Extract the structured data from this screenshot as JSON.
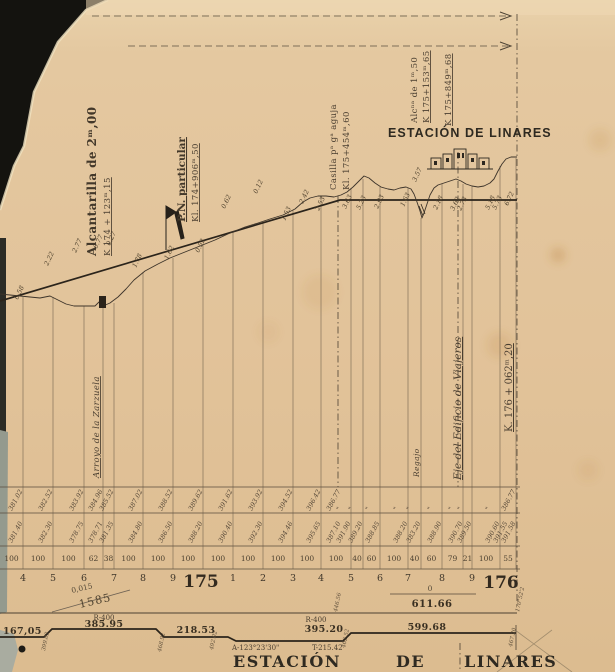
{
  "labels": {
    "alc2": {
      "l1": "Alcantarilla de 2ᵐ,00",
      "l2": "K 174 + 123ᵐ,15"
    },
    "pn": {
      "l1": "P.N. particular",
      "l2": "Kl. 174+906ᵐ,50"
    },
    "casilla": {
      "l1": "Casilla pᵃ gᵃ aguja",
      "l2": "Kl. 175+454ᵐ,60"
    },
    "alc1": {
      "l1": "Alcⁿᵃ de 1ᵐ,50",
      "l2": "K 175+153ᵐ,65"
    },
    "k849": "K 175+849ᵐ,68",
    "stamp": "ESTACIÓN DE LINARES",
    "arroyo": "Arroyo de la Zarzuela",
    "regajo": "Regajo",
    "eje": "Eje del Edificio de Viajeros",
    "k176": "K. 176 + 062ᵐ,20",
    "grad_left_num": "0,015",
    "grad_left_len": "1585",
    "grad_right_num": "0",
    "grad_right_len": "611.66",
    "al_s1": "167,05",
    "al_r1": "R-400",
    "al_c1": "385.95",
    "al_s2": "218.53",
    "al_r2": "R-400",
    "al_c2": "395.20",
    "al_a2": "A-123°23'30\"",
    "al_t2": "T-215.42",
    "al_s3": "599.68",
    "km_l": "175",
    "km_r": "176",
    "title_1": "ESTACIÓN",
    "title_2": "DE",
    "title_3": "LINARES"
  },
  "colors": {
    "paper": "#e2c49c",
    "ink": "#3a3127",
    "ink_heavy": "#2b241b",
    "ink_faint": "#6b5d49",
    "scan_bg": "#14130f"
  },
  "draw": {
    "fold": [
      [
        92,
        16,
        508
      ],
      [
        128,
        46,
        508
      ]
    ],
    "dashdot": [
      [
        338,
        196,
        487
      ],
      [
        458,
        152,
        487
      ],
      [
        517,
        14,
        608
      ],
      [
        460,
        643,
        672
      ]
    ],
    "rasante": "0,301 340,200 517,200",
    "terrain": "0,294 20,296 40,298 50,296 58,300 66,304 74,306 95,306 99,302 103,306 110,303 118,297 126,289 134,280 145,271 158,264 170,258 185,252 200,246 215,240 230,233 245,227 258,223 270,219 283,215 295,209 303,202 310,198 318,196 326,196 334,197 341,195 347,192 353,187 359,181 364,176 369,178 375,183 381,187 388,189 394,190 400,188 406,187 411,189 414,194 417,202 420,211 422,218 424,213 427,204 430,195 434,188 438,185 444,183 450,181 456,179 461,181 466,184 472,186 478,187 484,186 490,183 494,179 498,171 502,164 506,159 511,157 517,157",
    "ordinates": [
      [
        23,
        297
      ],
      [
        53,
        297
      ],
      [
        84,
        306
      ],
      [
        103,
        308
      ],
      [
        114,
        303
      ],
      [
        143,
        272
      ],
      [
        173,
        258
      ],
      [
        203,
        245
      ],
      [
        233,
        232
      ],
      [
        263,
        222
      ],
      [
        293,
        210
      ],
      [
        321,
        196
      ],
      [
        351,
        188
      ],
      [
        363,
        179
      ],
      [
        380,
        187
      ],
      [
        408,
        188
      ],
      [
        421,
        218
      ],
      [
        442,
        184
      ],
      [
        463,
        184
      ],
      [
        472,
        186
      ],
      [
        500,
        166
      ],
      [
        516,
        158
      ]
    ],
    "spots": [
      [
        18,
        300,
        "0.58"
      ],
      [
        48,
        266,
        "2.22"
      ],
      [
        76,
        253,
        "2.77"
      ],
      [
        97,
        249,
        "0.77"
      ],
      [
        110,
        246,
        "0.27"
      ],
      [
        136,
        268,
        "1.78"
      ],
      [
        168,
        260,
        "1.62"
      ],
      [
        199,
        253,
        "0.52"
      ],
      [
        225,
        209,
        "0.62"
      ],
      [
        257,
        194,
        "0.12"
      ],
      [
        285,
        221,
        "1.53"
      ],
      [
        303,
        204,
        "2.42"
      ],
      [
        319,
        211,
        "2.53"
      ],
      [
        346,
        209,
        "3.63"
      ],
      [
        360,
        210,
        "5.23"
      ],
      [
        378,
        209,
        "2.93"
      ],
      [
        404,
        207,
        "1.63"
      ],
      [
        416,
        182,
        "3.57"
      ],
      [
        437,
        210,
        "2.18"
      ],
      [
        454,
        211,
        "3.62"
      ],
      [
        461,
        211,
        "2.73"
      ],
      [
        489,
        210,
        "5.18"
      ],
      [
        496,
        210,
        "5.73"
      ],
      [
        508,
        206,
        "6.72"
      ]
    ],
    "table": {
      "rows": [
        487,
        513,
        546,
        569
      ],
      "bottom_line": 613,
      "ticks": [
        [
          23,
          "381.02",
          "381.40"
        ],
        [
          53,
          "382.52",
          "382.30"
        ],
        [
          84,
          "383.92",
          "378.75"
        ],
        [
          103,
          "384.96",
          "378.71"
        ],
        [
          114,
          "385.52",
          "381.35"
        ],
        [
          143,
          "387.02",
          "384.80"
        ],
        [
          173,
          "388.52",
          "386.50"
        ],
        [
          203,
          "389.62",
          "388.20"
        ],
        [
          233,
          "391.62",
          "390.40"
        ],
        [
          263,
          "393.92",
          "392.30"
        ],
        [
          293,
          "394.52",
          "394.46"
        ],
        [
          321,
          "396.42",
          "395.65"
        ],
        [
          341,
          "386.77",
          "387.10"
        ],
        [
          351,
          "\"",
          "391.90"
        ],
        [
          363,
          "\"",
          "389.20"
        ],
        [
          380,
          "\"",
          "388.85"
        ],
        [
          408,
          "\"",
          "388.20"
        ],
        [
          421,
          "\"",
          "383.20"
        ],
        [
          442,
          "\"",
          "388.90"
        ],
        [
          463,
          "\"",
          "390.70"
        ],
        [
          472,
          "\"",
          "389.50"
        ],
        [
          500,
          "\"",
          "390.60"
        ],
        [
          508,
          "",
          "391.55"
        ],
        [
          516,
          "386.77",
          "391.58"
        ]
      ],
      "cells": [
        [
          0,
          23,
          "100"
        ],
        [
          23,
          53,
          "100"
        ],
        [
          53,
          84,
          "100"
        ],
        [
          84,
          103,
          "62"
        ],
        [
          103,
          114,
          "38"
        ],
        [
          114,
          143,
          "100"
        ],
        [
          143,
          173,
          "100"
        ],
        [
          173,
          203,
          "100"
        ],
        [
          203,
          233,
          "100"
        ],
        [
          233,
          263,
          "100"
        ],
        [
          263,
          293,
          "100"
        ],
        [
          293,
          321,
          "100"
        ],
        [
          321,
          351,
          "100"
        ],
        [
          351,
          363,
          "40"
        ],
        [
          363,
          380,
          "60"
        ],
        [
          380,
          408,
          "100"
        ],
        [
          408,
          421,
          "40"
        ],
        [
          421,
          442,
          "60"
        ],
        [
          442,
          463,
          "79"
        ],
        [
          463,
          472,
          "21"
        ],
        [
          472,
          500,
          "100"
        ],
        [
          500,
          516,
          "55"
        ]
      ],
      "hm": [
        [
          23,
          "4",
          0
        ],
        [
          53,
          "5",
          0
        ],
        [
          84,
          "6",
          0
        ],
        [
          114,
          "7",
          0
        ],
        [
          143,
          "8",
          0
        ],
        [
          173,
          "9",
          0
        ],
        [
          201,
          "175",
          1
        ],
        [
          233,
          "1",
          0
        ],
        [
          263,
          "2",
          0
        ],
        [
          293,
          "3",
          0
        ],
        [
          321,
          "4",
          0
        ],
        [
          351,
          "5",
          0
        ],
        [
          380,
          "6",
          0
        ],
        [
          408,
          "7",
          0
        ],
        [
          442,
          "8",
          0
        ],
        [
          472,
          "9",
          0
        ],
        [
          500,
          "176",
          1
        ]
      ]
    },
    "align": {
      "path": "0,637 44,637 52,629 156,629 164,637 228,637 236,641 343,641 351,633 516,633",
      "end_tick": [
        516,
        625,
        650
      ],
      "marks": [
        [
          45,
          651,
          "399.02"
        ],
        [
          161,
          652,
          "468.92"
        ],
        [
          213,
          650,
          "492.02"
        ],
        [
          345,
          648,
          "462.52"
        ],
        [
          512,
          647,
          "467.20"
        ],
        [
          337,
          612,
          "446.56"
        ],
        [
          519,
          612,
          "170°52'2"
        ]
      ]
    }
  }
}
